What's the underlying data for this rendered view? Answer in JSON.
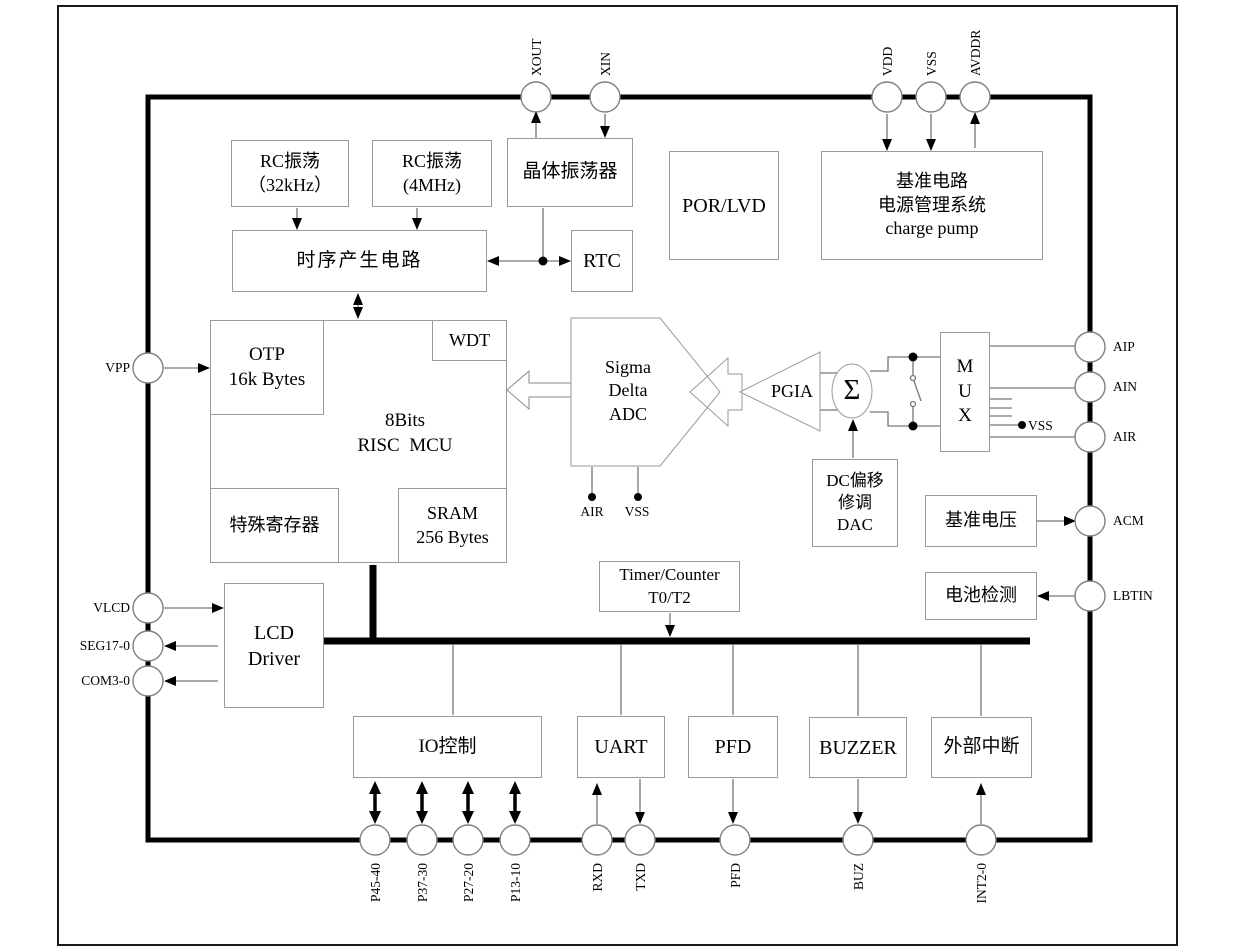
{
  "blocks": {
    "rc32": {
      "line1": "RC振荡",
      "line2": "（32kHz）"
    },
    "rc4": {
      "line1": "RC振荡",
      "line2": "(4MHz)"
    },
    "crystal": {
      "label": "晶体振荡器"
    },
    "por": {
      "label": "POR/LVD"
    },
    "power": {
      "line1": "基准电路",
      "line2": "电源管理系统",
      "line3": "charge pump"
    },
    "timing": {
      "label": "时序产生电路"
    },
    "rtc": {
      "label": "RTC"
    },
    "otp": {
      "line1": "OTP",
      "line2": "16k Bytes"
    },
    "wdt": {
      "label": "WDT"
    },
    "mcu": {
      "line1": "8Bits",
      "line2": "RISC  MCU"
    },
    "sfr": {
      "label": "特殊寄存器"
    },
    "sram": {
      "line1": "SRAM",
      "line2": "256 Bytes"
    },
    "adc": {
      "line1": "Sigma",
      "line2": "Delta",
      "line3": "ADC"
    },
    "pgia": {
      "label": "PGIA"
    },
    "sum": {
      "label": "Σ"
    },
    "mux": {
      "line1": "M",
      "line2": "U",
      "line3": "X"
    },
    "dac": {
      "line1": "DC偏移",
      "line2": "修调",
      "line3": "DAC"
    },
    "vref": {
      "label": "基准电压"
    },
    "battery": {
      "label": "电池检测"
    },
    "lcd": {
      "line1": "LCD",
      "line2": "Driver"
    },
    "timer": {
      "line1": "Timer/Counter",
      "line2": "T0/T2"
    },
    "io": {
      "label": "IO控制"
    },
    "uart": {
      "label": "UART"
    },
    "pfd": {
      "label": "PFD"
    },
    "buzzer": {
      "label": "BUZZER"
    },
    "extint": {
      "label": "外部中断"
    }
  },
  "pins": {
    "top": [
      {
        "label": "XOUT"
      },
      {
        "label": "XIN"
      },
      {
        "label": "VDD"
      },
      {
        "label": "VSS"
      },
      {
        "label": "AVDDR"
      }
    ],
    "left": [
      {
        "label": "VPP"
      },
      {
        "label": "VLCD"
      },
      {
        "label": "SEG17-0"
      },
      {
        "label": "COM3-0"
      }
    ],
    "right": [
      {
        "label": "AIP"
      },
      {
        "label": "AIN"
      },
      {
        "label": "AIR"
      },
      {
        "label": "ACM"
      },
      {
        "label": "LBTIN"
      }
    ],
    "bottom": [
      {
        "label": "P45-40"
      },
      {
        "label": "P37-30"
      },
      {
        "label": "P27-20"
      },
      {
        "label": "P13-10"
      },
      {
        "label": "RXD"
      },
      {
        "label": "TXD"
      },
      {
        "label": "PFD"
      },
      {
        "label": "BUZ"
      },
      {
        "label": "INT2-0"
      }
    ]
  },
  "inline_labels": {
    "adc_air": "AIR",
    "adc_vss": "VSS",
    "mux_vss": "VSS"
  },
  "colors": {
    "wire": "#777777",
    "box_border": "#9a9a9a",
    "thick": "#000000",
    "text": "#000000"
  }
}
